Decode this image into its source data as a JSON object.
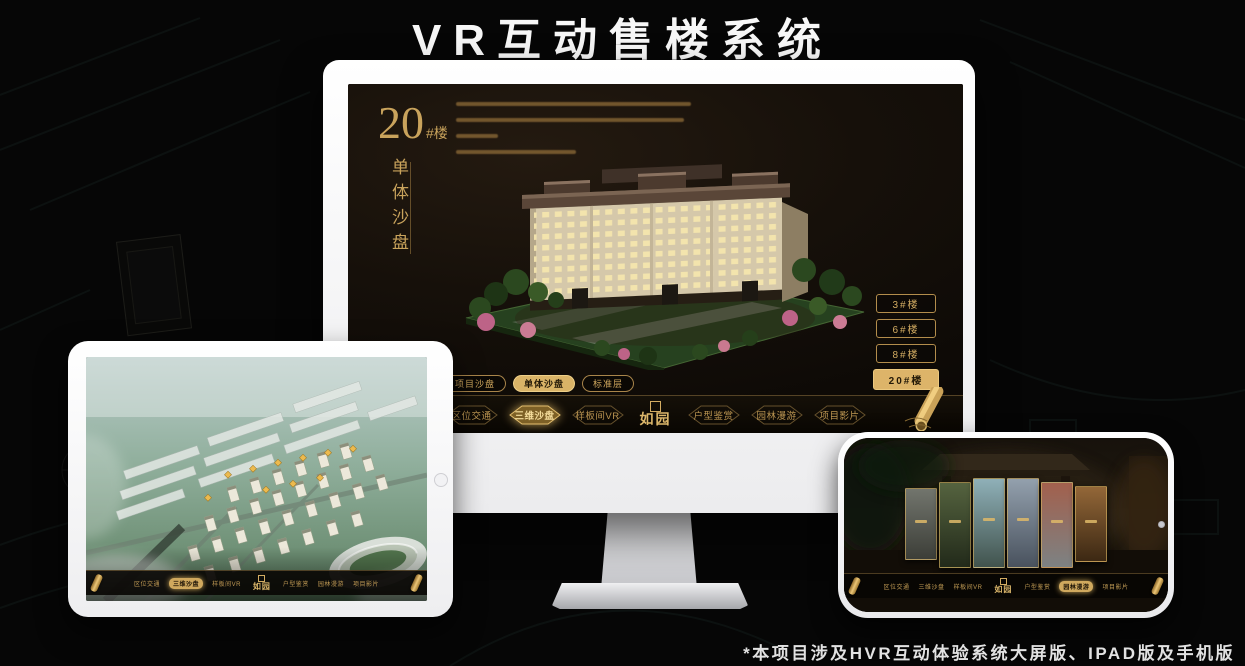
{
  "header": {
    "title": "VR互动售楼系统"
  },
  "footnote": "*本项目涉及HVR互动体验系统大屏版、IPAD版及手机版",
  "colors": {
    "gold": "#c9a05a",
    "gold_bright": "#e3b96a",
    "screen_bg": "#0c0906"
  },
  "monitor": {
    "heading": {
      "number": "20",
      "suffix": "#楼",
      "vertical_label": "单体沙盘"
    },
    "building_buttons": [
      {
        "label": "3#楼",
        "active": false
      },
      {
        "label": "6#楼",
        "active": false
      },
      {
        "label": "8#楼",
        "active": false
      },
      {
        "label": "20#楼",
        "active": true
      }
    ],
    "view_tabs": [
      {
        "label": "项目沙盘",
        "active": false
      },
      {
        "label": "单体沙盘",
        "active": true
      },
      {
        "label": "标准层",
        "active": false
      }
    ],
    "nav": {
      "logo": "如园",
      "items": [
        {
          "label": "区位交通",
          "active": false
        },
        {
          "label": "三维沙盘",
          "active": true
        },
        {
          "label": "样板间VR",
          "active": false
        },
        {
          "label": "户型鉴赏",
          "active": false
        },
        {
          "label": "园林漫游",
          "active": false
        },
        {
          "label": "项目影片",
          "active": false
        }
      ]
    }
  },
  "ipad": {
    "view_tabs": [
      {
        "label": "项目沙盘",
        "active": true
      },
      {
        "label": "单体沙盘",
        "active": false
      },
      {
        "label": "标准层",
        "active": false
      }
    ],
    "nav": {
      "logo": "如园",
      "items": [
        {
          "label": "区位交通",
          "active": false
        },
        {
          "label": "三维沙盘",
          "active": true
        },
        {
          "label": "样板间VR",
          "active": false
        },
        {
          "label": "户型鉴赏",
          "active": false
        },
        {
          "label": "园林漫游",
          "active": false
        },
        {
          "label": "项目影片",
          "active": false
        }
      ]
    }
  },
  "phone": {
    "nav": {
      "logo": "如园",
      "items": [
        {
          "label": "区位交通",
          "active": false
        },
        {
          "label": "三维沙盘",
          "active": false
        },
        {
          "label": "样板间VR",
          "active": false
        },
        {
          "label": "户型鉴赏",
          "active": false
        },
        {
          "label": "园林漫游",
          "active": true
        },
        {
          "label": "项目影片",
          "active": false
        }
      ]
    }
  }
}
